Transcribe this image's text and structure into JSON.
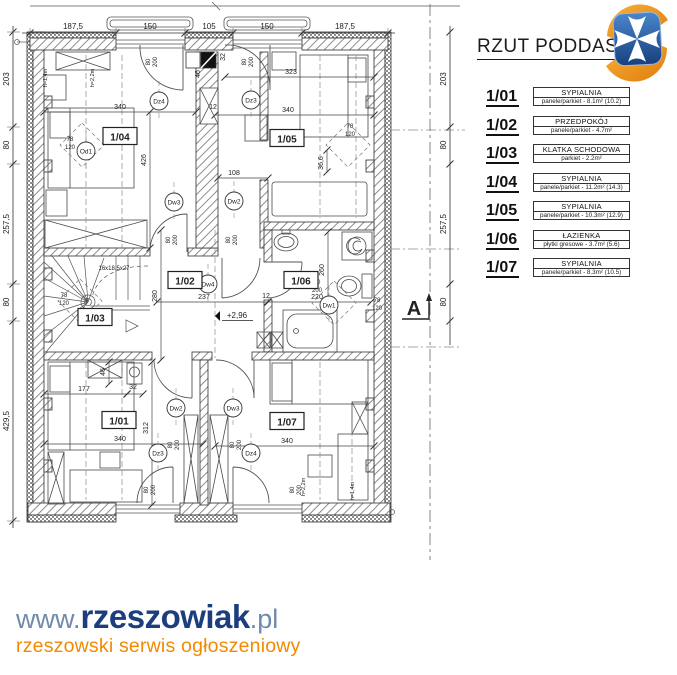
{
  "header": {
    "title": "RZUT PODDASZ"
  },
  "logo": {
    "name": "herb-rzeszowa",
    "blue": "#2a5ea8",
    "blue_dark": "#17407f",
    "orange": "#f59120",
    "orange_dark": "#e07b0c"
  },
  "legend": {
    "rooms": [
      {
        "no": "1/01",
        "name": "SYPIALNIA",
        "desc": "panele/parkiet - 8.1m² (10.2)"
      },
      {
        "no": "1/02",
        "name": "PRZEDPOKÓJ",
        "desc": "panele/parkiet - 4.7m²"
      },
      {
        "no": "1/03",
        "name": "KLATKA SCHODOWA",
        "desc": "parkiet - 2.2m²"
      },
      {
        "no": "1/04",
        "name": "SYPIALNIA",
        "desc": "panele/parkiet - 11.2m² (14.3)"
      },
      {
        "no": "1/05",
        "name": "SYPIALNIA",
        "desc": "panele/parkiet - 10.3m² (12.9)"
      },
      {
        "no": "1/06",
        "name": "ŁAZIENKA",
        "desc": "płytki gresowe - 3.7m² (5.6)"
      },
      {
        "no": "1/07",
        "name": "SYPIALNIA",
        "desc": "panele/parkiet - 8.3m² (10.5)"
      }
    ]
  },
  "plan": {
    "room_labels": [
      {
        "t": "1/04",
        "x": 120,
        "y": 137
      },
      {
        "t": "1/05",
        "x": 287,
        "y": 139
      },
      {
        "t": "1/02",
        "x": 185,
        "y": 281
      },
      {
        "t": "1/06",
        "x": 301,
        "y": 281
      },
      {
        "t": "1/03",
        "x": 95,
        "y": 318
      },
      {
        "t": "1/01",
        "x": 119,
        "y": 421
      },
      {
        "t": "1/07",
        "x": 287,
        "y": 422
      }
    ],
    "codes": [
      {
        "t": "Od1",
        "x": 86,
        "y": 151
      },
      {
        "t": "Dz4",
        "x": 159,
        "y": 101
      },
      {
        "t": "Dz3",
        "x": 251,
        "y": 100
      },
      {
        "t": "Dw3",
        "x": 174,
        "y": 202
      },
      {
        "t": "Dw2",
        "x": 234,
        "y": 201
      },
      {
        "t": "Dw4",
        "x": 208,
        "y": 284
      },
      {
        "t": "Dw1",
        "x": 329,
        "y": 305
      },
      {
        "t": "Dw2",
        "x": 176,
        "y": 408
      },
      {
        "t": "Dw3",
        "x": 233,
        "y": 408
      },
      {
        "t": "Dz3",
        "x": 158,
        "y": 453
      },
      {
        "t": "Dz4",
        "x": 251,
        "y": 453
      }
    ],
    "dims_top": {
      "y": 33,
      "ticks": [
        30,
        116,
        185,
        233,
        302,
        388
      ],
      "labels": [
        {
          "t": "187,5",
          "x": 73
        },
        {
          "t": "150",
          "x": 150
        },
        {
          "t": "105",
          "x": 209
        },
        {
          "t": "150",
          "x": 267
        },
        {
          "t": "187,5",
          "x": 345
        }
      ]
    },
    "dims_left": {
      "x": 13,
      "ticks": [
        32,
        127,
        164,
        284,
        321,
        521
      ],
      "labels": [
        {
          "t": "203",
          "y": 79
        },
        {
          "t": "80",
          "y": 145
        },
        {
          "t": "257,5",
          "y": 224
        },
        {
          "t": "80",
          "y": 302
        },
        {
          "t": "429,5",
          "y": 421
        }
      ]
    },
    "dims_right": {
      "x": 450,
      "ticks": [
        32,
        127,
        164,
        284,
        321
      ],
      "labels": [
        {
          "t": "203",
          "y": 79
        },
        {
          "t": "80",
          "y": 145
        },
        {
          "t": "257,5",
          "y": 224
        },
        {
          "t": "80",
          "y": 302
        }
      ]
    },
    "annotations": [
      {
        "t": "340",
        "x": 120,
        "y": 109,
        "line": [
          44,
          112,
          196,
          112
        ]
      },
      {
        "t": "426",
        "x": 146,
        "y": 160,
        "r": 1,
        "line": [
          150,
          112,
          150,
          248
        ]
      },
      {
        "t": "323",
        "x": 291,
        "y": 74,
        "line": [
          225,
          77,
          374,
          77
        ]
      },
      {
        "t": "340",
        "x": 288,
        "y": 112,
        "line": [
          215,
          115,
          374,
          115
        ]
      },
      {
        "t": "108",
        "x": 234,
        "y": 175,
        "line": [
          218,
          178,
          268,
          178
        ]
      },
      {
        "t": "12",
        "x": 213,
        "y": 109
      },
      {
        "t": "32",
        "x": 225,
        "y": 57,
        "r": 1
      },
      {
        "t": "46",
        "x": 200,
        "y": 74,
        "r": 1
      },
      {
        "t": "36,6",
        "x": 323,
        "y": 163,
        "r": 1,
        "line": [
          327,
          150,
          327,
          172
        ]
      },
      {
        "t": "237",
        "x": 204,
        "y": 299,
        "line": [
          157,
          302,
          268,
          302
        ]
      },
      {
        "t": "280",
        "x": 157,
        "y": 296,
        "r": 1,
        "line": [
          161,
          230,
          161,
          360
        ]
      },
      {
        "t": "12",
        "x": 266,
        "y": 298
      },
      {
        "t": "220",
        "x": 317,
        "y": 299,
        "line": [
          268,
          302,
          371,
          302
        ]
      },
      {
        "t": "260",
        "x": 324,
        "y": 270,
        "r": 1,
        "line": [
          328,
          232,
          328,
          308
        ]
      },
      {
        "t": "16x18,5x27",
        "x": 114,
        "y": 270,
        "s": 6
      },
      {
        "t": "177",
        "x": 84,
        "y": 391,
        "line": [
          44,
          394,
          127,
          394
        ]
      },
      {
        "t": "32",
        "x": 133,
        "y": 389,
        "line": [
          127,
          394,
          143,
          394
        ]
      },
      {
        "t": "312",
        "x": 148,
        "y": 428,
        "r": 1,
        "line": [
          152,
          362,
          152,
          505
        ]
      },
      {
        "t": "340",
        "x": 120,
        "y": 441,
        "line": [
          44,
          444,
          203,
          444
        ]
      },
      {
        "t": "340",
        "x": 287,
        "y": 443,
        "line": [
          215,
          446,
          374,
          446
        ]
      },
      {
        "t": "46",
        "x": 105,
        "y": 372,
        "r": 1,
        "line": [
          109,
          362,
          109,
          384
        ]
      },
      {
        "t": "+2,96",
        "x": 237,
        "y": 318,
        "s": 8,
        "ul": 1
      },
      {
        "t": "78",
        "x": 70,
        "y": 141,
        "s": 6
      },
      {
        "t": "120",
        "x": 70,
        "y": 149,
        "s": 6
      },
      {
        "t": "78",
        "x": 350,
        "y": 128,
        "s": 6
      },
      {
        "t": "120",
        "x": 350,
        "y": 136,
        "s": 6
      },
      {
        "t": "78",
        "x": 377,
        "y": 302,
        "s": 6
      },
      {
        "t": "120",
        "x": 377,
        "y": 310,
        "s": 6
      },
      {
        "t": "78",
        "x": 64,
        "y": 297,
        "s": 6
      },
      {
        "t": "120",
        "x": 64,
        "y": 305,
        "s": 6
      },
      {
        "t": "80",
        "x": 150,
        "y": 62,
        "r": 1,
        "s": 6
      },
      {
        "t": "200",
        "x": 157,
        "y": 62,
        "r": 1,
        "s": 6
      },
      {
        "t": "80",
        "x": 246,
        "y": 62,
        "r": 1,
        "s": 6
      },
      {
        "t": "200",
        "x": 253,
        "y": 62,
        "r": 1,
        "s": 6
      },
      {
        "t": "80",
        "x": 170,
        "y": 240,
        "r": 1,
        "s": 6
      },
      {
        "t": "200",
        "x": 177,
        "y": 240,
        "r": 1,
        "s": 6
      },
      {
        "t": "80",
        "x": 230,
        "y": 240,
        "r": 1,
        "s": 6
      },
      {
        "t": "200",
        "x": 237,
        "y": 240,
        "r": 1,
        "s": 6
      },
      {
        "t": "80",
        "x": 317,
        "y": 284,
        "s": 6
      },
      {
        "t": "200",
        "x": 317,
        "y": 292,
        "s": 6
      },
      {
        "t": "80",
        "x": 172,
        "y": 445,
        "r": 1,
        "s": 6
      },
      {
        "t": "200",
        "x": 179,
        "y": 445,
        "r": 1,
        "s": 6
      },
      {
        "t": "80",
        "x": 234,
        "y": 445,
        "r": 1,
        "s": 6
      },
      {
        "t": "200",
        "x": 241,
        "y": 445,
        "r": 1,
        "s": 6
      },
      {
        "t": "80",
        "x": 148,
        "y": 490,
        "r": 1,
        "s": 6
      },
      {
        "t": "200",
        "x": 155,
        "y": 490,
        "r": 1,
        "s": 6
      },
      {
        "t": "80",
        "x": 294,
        "y": 490,
        "r": 1,
        "s": 6
      },
      {
        "t": "200",
        "x": 301,
        "y": 490,
        "r": 1,
        "s": 6
      },
      {
        "t": "h=1,4m",
        "x": 47,
        "y": 78,
        "r": 1,
        "s": 5.5
      },
      {
        "t": "h=2,2m",
        "x": 94,
        "y": 78,
        "r": 1,
        "s": 5.5
      },
      {
        "t": "h=2,2m",
        "x": 305,
        "y": 487,
        "r": 1,
        "s": 5.5
      },
      {
        "t": "h=1,4m",
        "x": 354,
        "y": 491,
        "r": 1,
        "s": 5.5
      }
    ],
    "diamonds": [
      [
        82,
        145
      ],
      [
        348,
        145
      ],
      [
        334,
        303
      ],
      [
        80,
        301
      ]
    ],
    "section": {
      "label": "A",
      "x": 414,
      "y": 315,
      "line_x": 430
    }
  },
  "footer": {
    "www": "www.",
    "brand": "rzeszowiak",
    "tld": ".pl",
    "tagline": "rzeszowski serwis ogłoszeniowy"
  },
  "colors": {
    "line": "#2f2f2f",
    "dim": "#3a3a3a",
    "hatch": "#808080",
    "brand_navy": "#1d3e7e",
    "brand_light": "#7189ab",
    "brand_orange": "#f18a00"
  }
}
